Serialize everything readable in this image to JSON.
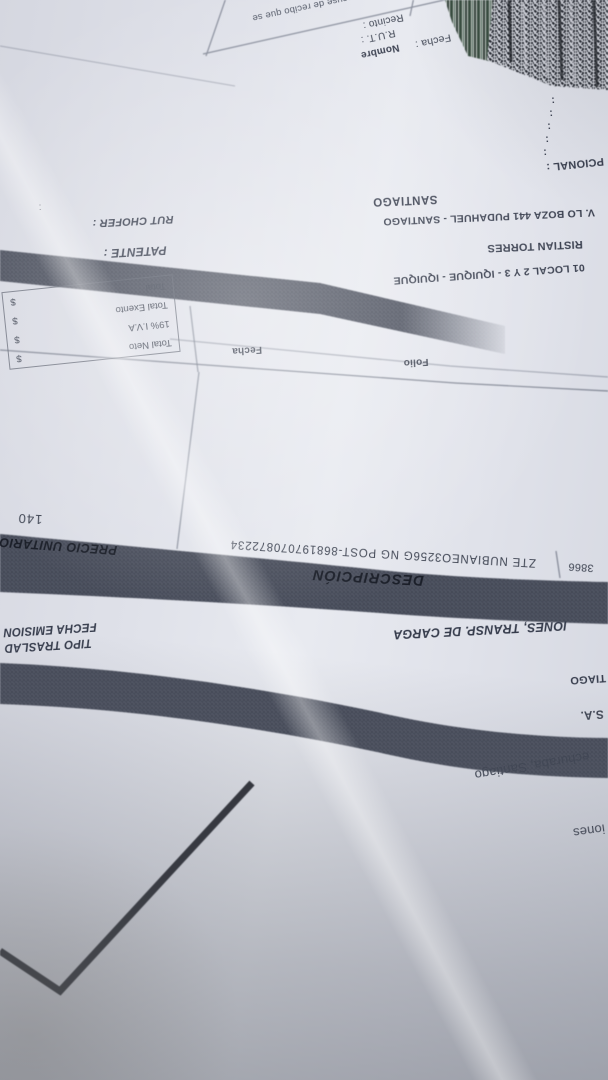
{
  "issuer": {
    "name_fragment": "iones",
    "address_fragment": "echuraba, Santiago",
    "company_sa_fragment": "S.A.",
    "city_fragment": "TIAGO",
    "giro_fragment": "IONES, TRANSP. DE CARGA",
    "tipo_traslado_label": "TIPO TRASLAD",
    "fecha_emision_label": "FECHA EMISION"
  },
  "items_table": {
    "description_header": "DESCRIPCIÓN",
    "unit_price_header": "PRECIO UNITARIO",
    "item": {
      "code_fragment": "3866",
      "description": "ZTE NUBIANEO3256G NG POST-868197070872234",
      "unit_price_fragment": "140"
    }
  },
  "references": {
    "folio_label": "Folio",
    "fecha_label": "Fecha"
  },
  "totals": {
    "rows": [
      {
        "label": "Total Neto",
        "currency": "$"
      },
      {
        "label": "19% I.V.A",
        "currency": "$"
      },
      {
        "label": "Total Exento",
        "currency": "$"
      },
      {
        "label": "Total",
        "currency": "$"
      }
    ]
  },
  "transport": {
    "patente_label": "PATENTE :",
    "rut_chofer_label": "RUT CHOFER :",
    "destination_fragment": "01 LOCAL 2 Y 3 - IQUIQUE - IQUIQUE",
    "driver_fragment": "RISTIAN TORRES",
    "address_fragment": "V. LO BOZA 441 PUDAHUEL - SANTIAGO",
    "city_fragment": "SANTIAGO",
    "stray_colon": ":"
  },
  "left_fields": {
    "opcional_fragment": "PCIONAL :",
    "colons": [
      ":",
      ":",
      ":",
      ":",
      ":"
    ]
  },
  "acuse_box": {
    "legal_fragment": "l acuse de recibo que se",
    "recinto_label": "Recinto :",
    "rut_label": "R.U.T. :",
    "nombre_label": "Nombre",
    "fecha_label": "Fecha :"
  },
  "colors": {
    "paper": "#dfe1e9",
    "ink": "#3e4452",
    "band": "#555a68",
    "band_text": "#1a1e28",
    "barcode_dark": "#191c24",
    "stripe_green": "#263c2d"
  }
}
